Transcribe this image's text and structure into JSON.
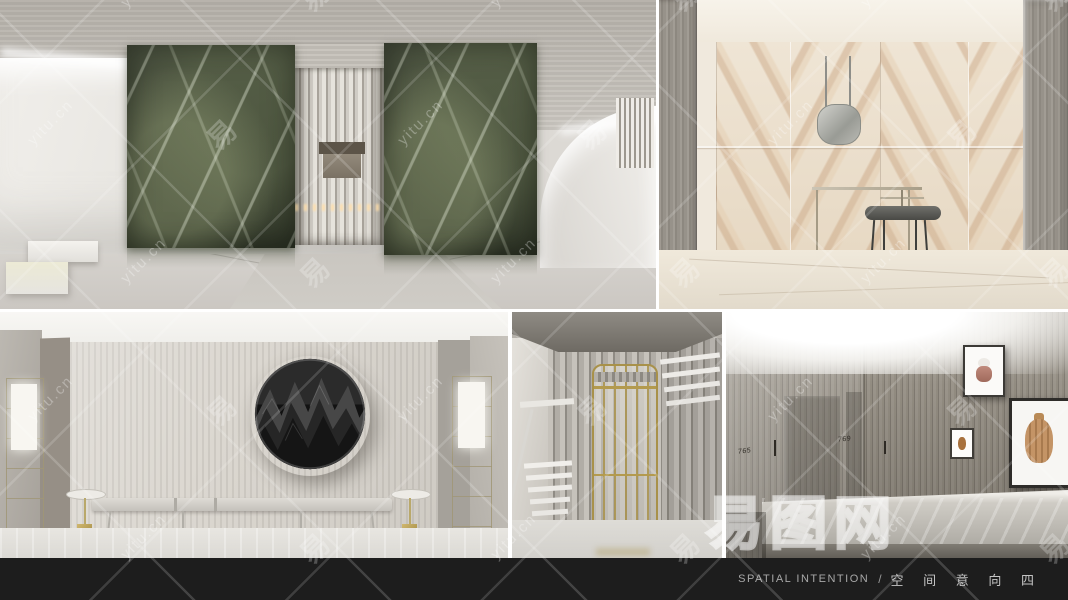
{
  "footer": {
    "title_en": "SPATIAL  INTENTION",
    "separator": "/",
    "title_zh": "空 间 意 向 四"
  },
  "watermark": {
    "domain_text": "yitu.cn",
    "glyph_text": "易",
    "brand_text": "易图网"
  },
  "corridor": {
    "door_number_1": "765",
    "door_number_2": "769"
  },
  "colors": {
    "footer_bg": "#1d1d1d",
    "footer_text": "#b4b4b4",
    "marble_green": "#3a4130",
    "onyx_beige": "#e7d9c4",
    "brass_gold": "#a8914a",
    "border_white": "#ffffff",
    "watermark_white": "rgba(255,255,255,0.3)"
  }
}
